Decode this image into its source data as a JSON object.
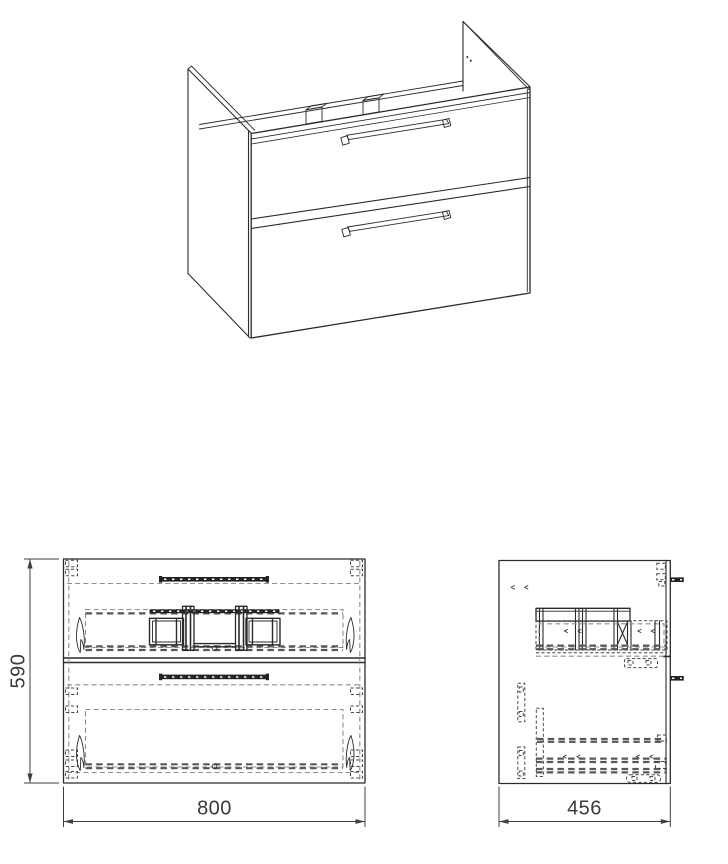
{
  "page": {
    "background_color": "#ffffff",
    "width": 728,
    "height": 864
  },
  "drawing": {
    "subject": "Wall-hung two-drawer bathroom vanity cabinet - technical drawing",
    "colors": {
      "line": "#2b2b2b",
      "hidden_line": "#8e8e8e",
      "dark_hidden_line": "#474747",
      "dimension": "#3a3a3a",
      "background": "#ffffff"
    },
    "views": {
      "perspective": {
        "name": "isometric-view",
        "description": "3D line drawing: open-top carcass, two drawers with bar handles, raised side panels"
      },
      "front": {
        "name": "front-elevation",
        "height_dim": {
          "label": "590"
        },
        "width_dim": {
          "label": "800"
        }
      },
      "side": {
        "name": "side-elevation",
        "depth_dim": {
          "label": "456"
        }
      }
    }
  }
}
